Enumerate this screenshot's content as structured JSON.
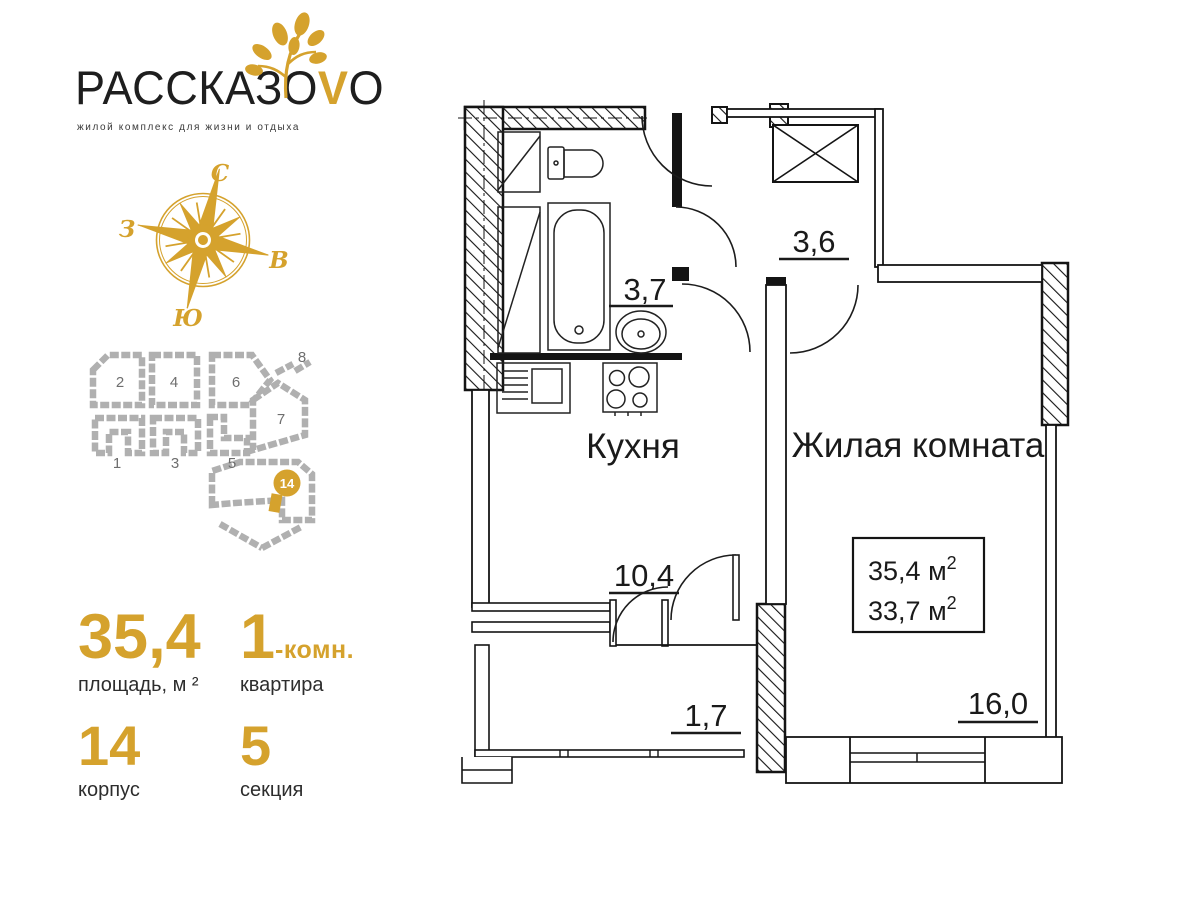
{
  "logo": {
    "title_main": "РАССКАЗО",
    "title_accent": "V",
    "title_end": "O",
    "tagline": "жилой комплекс для жизни и отдыха"
  },
  "compass": {
    "north": "С",
    "south": "Ю",
    "west": "З",
    "east": "В"
  },
  "sitemap": {
    "buildings": [
      "1",
      "2",
      "3",
      "4",
      "5",
      "6",
      "7",
      "8"
    ],
    "badge": "14"
  },
  "stats": {
    "area_value": "35,4",
    "area_label": "площадь, м ²",
    "rooms_value": "1",
    "rooms_suffix": "-комн.",
    "rooms_label": "квартира",
    "building_value": "14",
    "building_label": "корпус",
    "section_value": "5",
    "section_label": "секция"
  },
  "plan": {
    "rooms": {
      "kitchen": "Кухня",
      "living": "Жилая комната"
    },
    "areas": {
      "bathroom": "3,7",
      "hall": "3,6",
      "kitchen": "10,4",
      "balcony": "1,7",
      "living": "16,0"
    },
    "box": {
      "total": "35,4",
      "living": "33,7",
      "unit": " м",
      "sup": "2"
    }
  },
  "colors": {
    "gold": "#d5a22d",
    "ink": "#1a1a1a",
    "building_gray": "#b0b0b0"
  }
}
